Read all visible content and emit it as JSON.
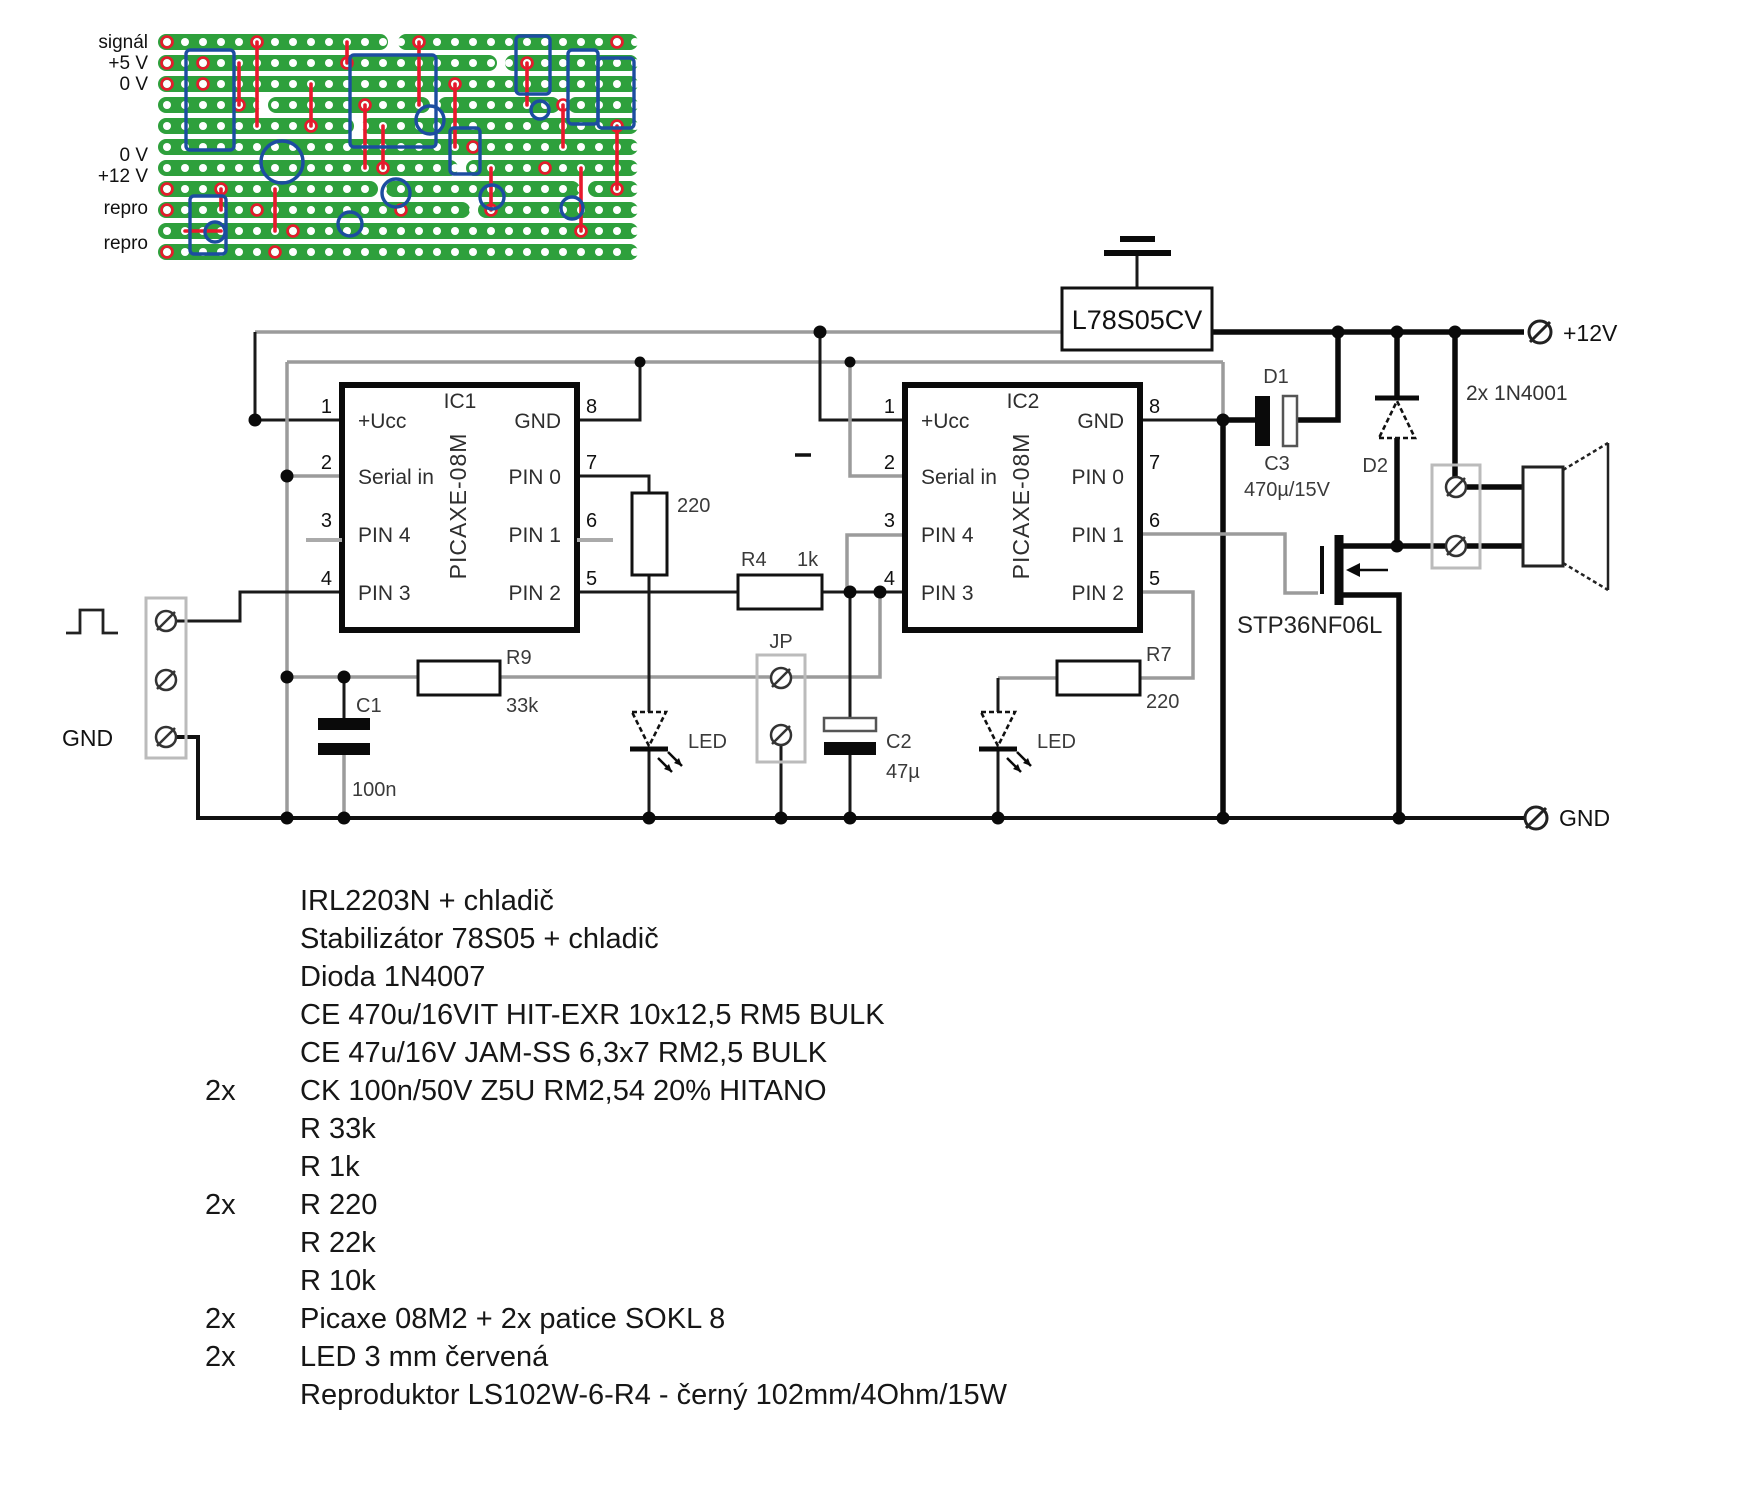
{
  "colors": {
    "board_green": "#2ea03c",
    "trace_red": "#e8192c",
    "outline_blue": "#1c4da0"
  },
  "stripboard": {
    "labels": [
      "signál",
      "+5 V",
      "0 V",
      "0 V",
      "+12 V",
      "repro",
      "repro"
    ]
  },
  "schematic": {
    "ic": {
      "num_left": [
        "1",
        "2",
        "3",
        "4"
      ],
      "num_right": [
        "8",
        "7",
        "6",
        "5"
      ],
      "pin_left": [
        "+Ucc",
        "Serial in",
        "PIN 4",
        "PIN 3"
      ],
      "pin_right": [
        "GND",
        "PIN 0",
        "PIN 1",
        "PIN 2"
      ],
      "chip": "PICAXE-08M"
    },
    "ic1_title": "IC1",
    "ic2_title": "IC2",
    "regulator": "L78S05CV",
    "mosfet": "STP36NF06L",
    "diodes_note": "2x 1N4001",
    "d1": "D1",
    "d2": "D2",
    "c1": "C1",
    "c1_val": "100n",
    "c2": "C2",
    "c2_val": "47µ",
    "c3": "C3",
    "c3_val": "470µ/15V",
    "r4": "R4",
    "r4_val": "1k",
    "r9": "R9",
    "r9_val": "33k",
    "r7": "R7",
    "r7_val": "220",
    "r220": "220",
    "jp": "JP",
    "led": "LED",
    "gnd_in": "GND",
    "vcc_out": "+12V",
    "gnd_out": "GND"
  },
  "parts": [
    {
      "q": "",
      "d": "IRL2203N + chladič"
    },
    {
      "q": "",
      "d": "Stabilizátor 78S05 + chladič"
    },
    {
      "q": "",
      "d": "Dioda 1N4007"
    },
    {
      "q": "",
      "d": "CE 470u/16VIT HIT-EXR 10x12,5 RM5 BULK"
    },
    {
      "q": "",
      "d": "CE 47u/16V JAM-SS 6,3x7 RM2,5 BULK"
    },
    {
      "q": "2x",
      "d": "CK 100n/50V Z5U RM2,54 20% HITANO"
    },
    {
      "q": "",
      "d": "R 33k"
    },
    {
      "q": "",
      "d": "R 1k"
    },
    {
      "q": "2x",
      "d": "R 220"
    },
    {
      "q": "",
      "d": "R 22k"
    },
    {
      "q": "",
      "d": "R 10k"
    },
    {
      "q": "2x",
      "d": "Picaxe 08M2 + 2x patice SOKL 8"
    },
    {
      "q": "2x",
      "d": "LED 3 mm červená"
    },
    {
      "q": "",
      "d": "Reproduktor LS102W-6-R4 - černý 102mm/4Ohm/15W"
    }
  ]
}
